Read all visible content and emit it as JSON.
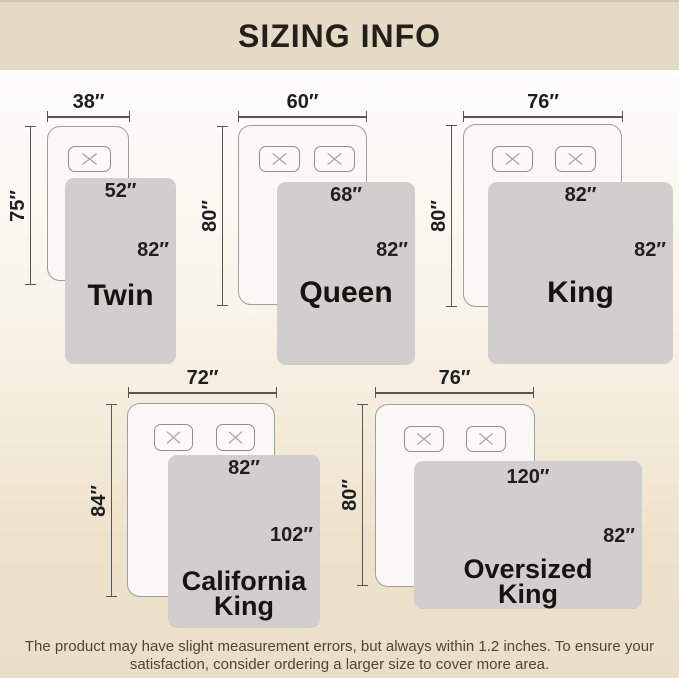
{
  "header": {
    "title": "SIZING INFO"
  },
  "footer": {
    "line1": "The product may have slight measurement errors, but always within 1.2 inches. To ensure your",
    "line2": "satisfaction, consider ordering a larger size to cover more area."
  },
  "colors": {
    "header_bg": "#e5dac6",
    "page_bg_bottom": "#ebdec6",
    "blanket_gray": "#d0cfcd",
    "mattress_white": "#f9f8f5",
    "label_text": "#1f1f1f"
  },
  "diagrams": [
    {
      "name": "Twin",
      "mattress_width": "38″",
      "mattress_length": "75″",
      "blanket_width": "52″",
      "blanket_length": "82″",
      "pillow_count": 1
    },
    {
      "name": "Queen",
      "mattress_width": "60″",
      "mattress_length": "80″",
      "blanket_width": "68″",
      "blanket_length": "82″",
      "pillow_count": 2
    },
    {
      "name": "King",
      "mattress_width": "76″",
      "mattress_length": "80″",
      "blanket_width": "82″",
      "blanket_length": "82″",
      "pillow_count": 2
    },
    {
      "name": "California King",
      "mattress_width": "72″",
      "mattress_length": "84″",
      "blanket_width": "82″",
      "blanket_length": "102″",
      "pillow_count": 2
    },
    {
      "name": "Oversized King",
      "mattress_width": "76″",
      "mattress_length": "80″",
      "blanket_width": "120″",
      "blanket_length": "82″",
      "pillow_count": 2
    }
  ]
}
